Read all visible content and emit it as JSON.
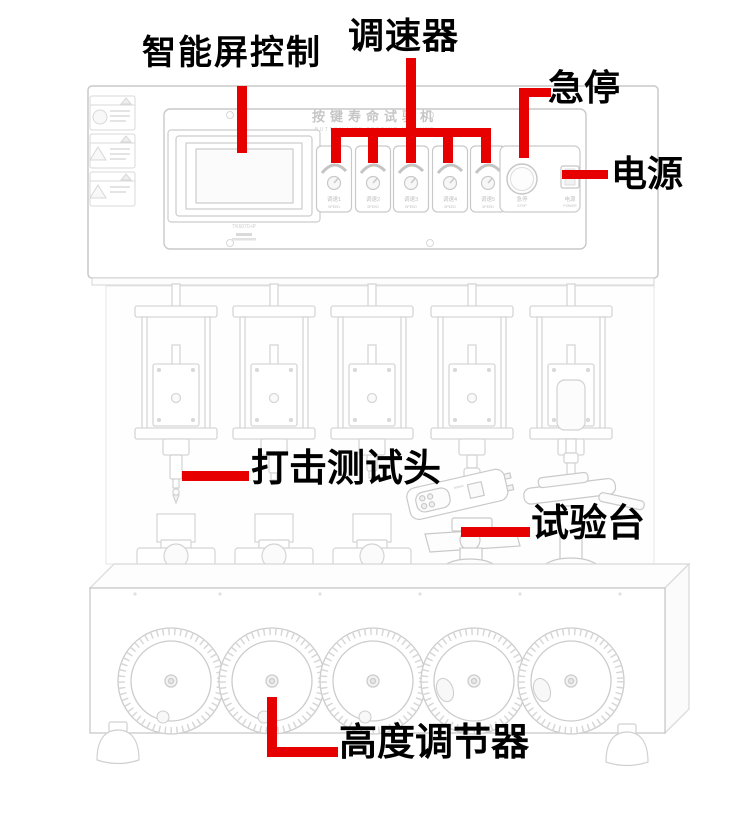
{
  "colors": {
    "annotation_red": "#e60000",
    "label_black": "#000000",
    "drawing_gray": "#d2d2d2"
  },
  "annotations": {
    "smart_screen_control": "智能屏控制",
    "speed_governor": "调速器",
    "emergency_stop": "急停",
    "power": "电源",
    "impact_test_head": "打击测试头",
    "test_bench": "试验台",
    "height_adjuster": "高度调节器"
  },
  "machine": {
    "panel": {
      "title": "按键寿命试验机",
      "subtitle": "BUTTON LIFE TESTING MACHINE",
      "screen_model": "TK6070-iP",
      "knobs": [
        {
          "label": "调速1",
          "sub": "SPEED"
        },
        {
          "label": "调速2",
          "sub": "SPEED"
        },
        {
          "label": "调速3",
          "sub": "SPEED"
        },
        {
          "label": "调速4",
          "sub": "SPEED"
        },
        {
          "label": "调速5",
          "sub": "SPEED"
        }
      ],
      "estop_label": "急停",
      "estop_sub": "STOP",
      "power_label": "电源",
      "power_sub": "POWER"
    }
  }
}
